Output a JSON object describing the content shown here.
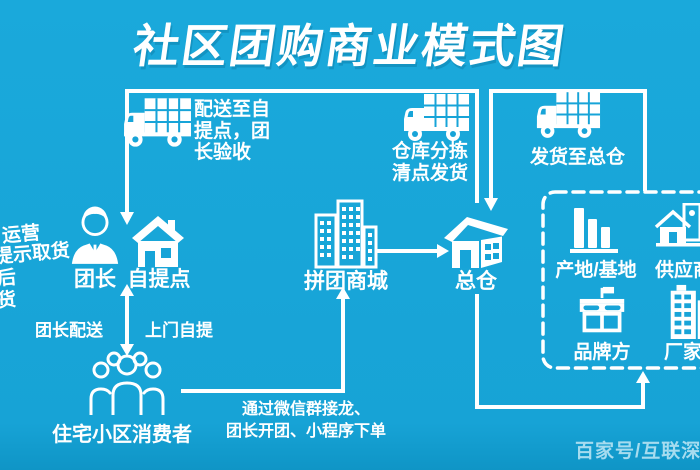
{
  "title": "社区团购商业模式图",
  "colors": {
    "background": "#17a4d8",
    "foreground": "#ffffff",
    "watermark": "#a6dcef"
  },
  "top_routes": [
    {
      "label": "配送至自提点，团长验收",
      "icon": "truck-icon"
    },
    {
      "label": "仓库分拣清点发货",
      "icon": "truck-icon"
    },
    {
      "label": "发货至总仓",
      "icon": "truck-icon"
    }
  ],
  "nodes": {
    "leader": {
      "label": "团长",
      "icon": "person-icon"
    },
    "pickup_point": {
      "label": "自提点",
      "icon": "house-icon"
    },
    "group_mall": {
      "label": "拼团商城",
      "icon": "buildings-icon"
    },
    "main_warehouse": {
      "label": "总仓",
      "icon": "warehouse-icon"
    },
    "consumers": {
      "label": "住宅小区消费者",
      "icon": "people-group-icon"
    }
  },
  "suppliers_box": {
    "items": [
      {
        "label": "产地/基地",
        "icon": "silo-bars-icon"
      },
      {
        "label": "供应商",
        "icon": "house-pin-icon"
      },
      {
        "label": "品牌方",
        "icon": "storefront-flag-icon"
      },
      {
        "label": "厂家",
        "icon": "factory-building-icon"
      }
    ]
  },
  "edge_labels": {
    "leader_delivery": "团长配送",
    "self_pickup": "上门自提",
    "order_channel": "通过微信群接龙、\n团长开团、小程序下单"
  },
  "side_notes": [
    "运营",
    "提示取货",
    "后",
    "货"
  ],
  "watermark": "百家号/互联深"
}
